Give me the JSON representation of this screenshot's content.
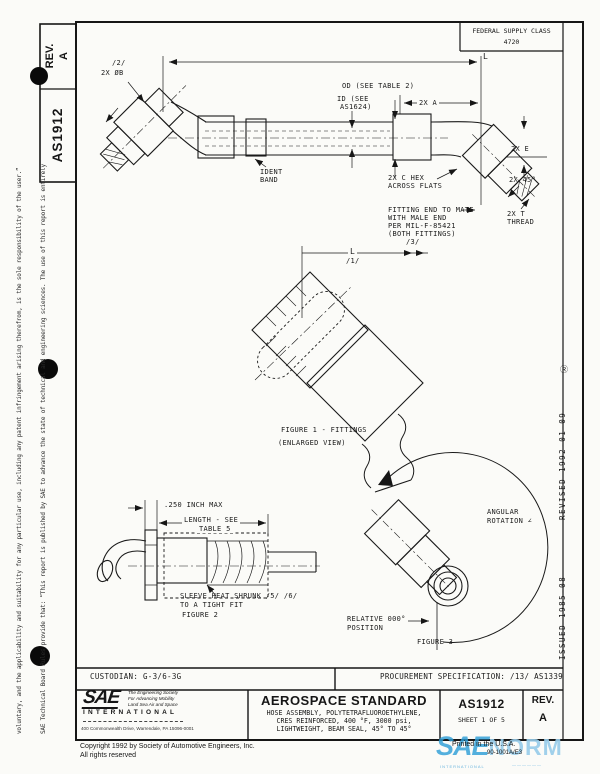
{
  "header": {
    "fsc_label": "FEDERAL SUPPLY CLASS",
    "fsc_value": "4720"
  },
  "doc_tab": {
    "rev_label": "REV.",
    "rev_value": "A",
    "doc_number": "AS1912"
  },
  "margins": {
    "left_line1": "SAE Technical Board Rules provide that: “This report is published by SAE to advance the state of technical and engineering sciences. The use of this report is entirely",
    "left_line2": "voluntary, and the applicability and suitability for any particular use, including any patent infringement arising therefrom, is the sole responsibility of the user.”",
    "revised": "REVISED  1992-01-09",
    "registered_mark": "Ⓡ",
    "issued": "ISSUED  1985-08"
  },
  "main_drawing": {
    "dim_L": "L",
    "flag_2": "/2/",
    "dia_b": "2X ØB",
    "od_note": "OD (SEE TABLE 2)",
    "id_note_l1": "ID (SEE",
    "id_note_l2": "AS1624)",
    "dim_2xa": "2X A",
    "ident_l1": "IDENT",
    "ident_l2": "BAND",
    "hex_l1": "2X C HEX",
    "hex_l2": "ACROSS FLATS",
    "dim_2xe": "2X E",
    "dim_2x45": "2X 45°",
    "mate_l1": "FITTING END TO MATE",
    "mate_l2": "WITH MALE END",
    "mate_l3": "PER MIL-F-85421",
    "mate_l4": "(BOTH FITTINGS)",
    "mate_l5": "/3/",
    "thread_l1": "2X T",
    "thread_l2": "THREAD"
  },
  "figure1": {
    "dim_L": "L",
    "flag_1": "/1/",
    "caption_l1": "FIGURE 1 - FITTINGS",
    "caption_l2": "(ENLARGED VIEW)"
  },
  "figure2": {
    "dim_250": ".250 INCH MAX",
    "dim_len_l1": "LENGTH - SEE",
    "dim_len_l2": "TABLE 5",
    "note_l1": "SLEEVE HEAT SHRUNK /5/ /6/",
    "note_l2": "TO A TIGHT FIT",
    "caption": "FIGURE 2"
  },
  "figure3": {
    "note_l1": "ANGULAR",
    "note_l2": "ROTATION  ∠",
    "rel_l1": "RELATIVE 000°",
    "rel_l2": "POSITION",
    "caption": "FIGURE 3"
  },
  "title_block": {
    "custodian": "CUSTODIAN:  G-3/6-3G",
    "procurement": "PROCUREMENT SPECIFICATION:  /13/  AS1339",
    "logo_text": "SAE",
    "logo_tag_l1": "The Engineering Society",
    "logo_tag_l2": "For Advancing Mobility",
    "logo_tag_l3": "Land Sea Air and Space",
    "logo_international": "INTERNATIONAL",
    "logo_address": "400 Commonwealth Drive, Warrendale, PA 15096-0001",
    "title": "AEROSPACE STANDARD",
    "subtitle_l1": "HOSE ASSEMBLY, POLYTETRAFLUOROETHYLENE,",
    "subtitle_l2": "CRES REINFORCED, 400 °F, 3000 psi,",
    "subtitle_l3": "LIGHTWEIGHT, BEAM SEAL, 45° TO 45°",
    "doc_number": "AS1912",
    "sheet": "SHEET 1 OF 5",
    "rev_label": "REV.",
    "rev_value": "A"
  },
  "footer": {
    "copyright_l1": "Copyright  1992  by Society of Automotive Engineers, Inc.",
    "copyright_l2": "All rights reserved",
    "printed": "Printed in the U.S.A.",
    "code": "90-1001A/E3"
  },
  "watermark": {
    "text1": "SAE",
    "text2": "NORM",
    "sub1": "INTERNATIONAL",
    "sub2": "——————",
    "color_dark": "#2f9fd8",
    "color_light": "#97ccea"
  }
}
